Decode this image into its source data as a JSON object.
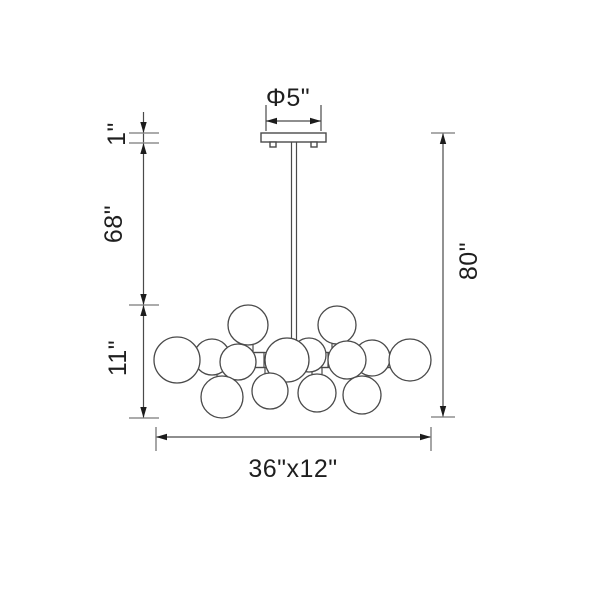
{
  "title": "Chandelier dimension drawing",
  "colors": {
    "line": "#4a4a4a",
    "tick": "#8f8f8f",
    "arrow": "#1c1c1c",
    "text": "#1f1f1f",
    "background": "#ffffff"
  },
  "diagram": {
    "labels": {
      "canopy_diameter": "Φ5\"",
      "canopy_height": "1\"",
      "rod_length": "68\"",
      "overall_height": "80\"",
      "fixture_height": "11\"",
      "fixture_width_depth": "36\"x12\""
    },
    "globes": [
      {
        "cx": 248,
        "cy": 325,
        "r": 20
      },
      {
        "cx": 337,
        "cy": 325,
        "r": 19
      },
      {
        "cx": 212,
        "cy": 357,
        "r": 18
      },
      {
        "cx": 309,
        "cy": 355,
        "r": 17
      },
      {
        "cx": 372,
        "cy": 358,
        "r": 18
      },
      {
        "cx": 238,
        "cy": 362,
        "r": 18
      },
      {
        "cx": 347,
        "cy": 360,
        "r": 19
      },
      {
        "cx": 287,
        "cy": 360,
        "r": 22
      },
      {
        "cx": 410,
        "cy": 360,
        "r": 21
      },
      {
        "cx": 177,
        "cy": 360,
        "r": 23
      },
      {
        "cx": 222,
        "cy": 397,
        "r": 21
      },
      {
        "cx": 270,
        "cy": 391,
        "r": 18
      },
      {
        "cx": 317,
        "cy": 393,
        "r": 19
      },
      {
        "cx": 362,
        "cy": 395,
        "r": 19
      }
    ],
    "sockets": [
      {
        "x": 194,
        "y": 352.5,
        "w": 12,
        "h": 15
      },
      {
        "x": 222,
        "y": 352.5,
        "w": 12,
        "h": 15
      },
      {
        "x": 252,
        "y": 352.5,
        "w": 12,
        "h": 15
      },
      {
        "x": 316,
        "y": 352.5,
        "w": 12,
        "h": 15
      },
      {
        "x": 364,
        "y": 352.5,
        "w": 12,
        "h": 15
      },
      {
        "x": 388,
        "y": 352.5,
        "w": 12,
        "h": 15
      }
    ],
    "stubs": [
      {
        "x": 243,
        "y": 343,
        "w": 10,
        "h": 9
      },
      {
        "x": 332,
        "y": 342,
        "w": 10,
        "h": 10
      },
      {
        "x": 217,
        "y": 367.5,
        "w": 10,
        "h": 10
      },
      {
        "x": 265,
        "y": 367.5,
        "w": 10,
        "h": 8
      },
      {
        "x": 312,
        "y": 367.5,
        "w": 10,
        "h": 8
      },
      {
        "x": 357,
        "y": 367.5,
        "w": 10,
        "h": 10
      }
    ]
  }
}
